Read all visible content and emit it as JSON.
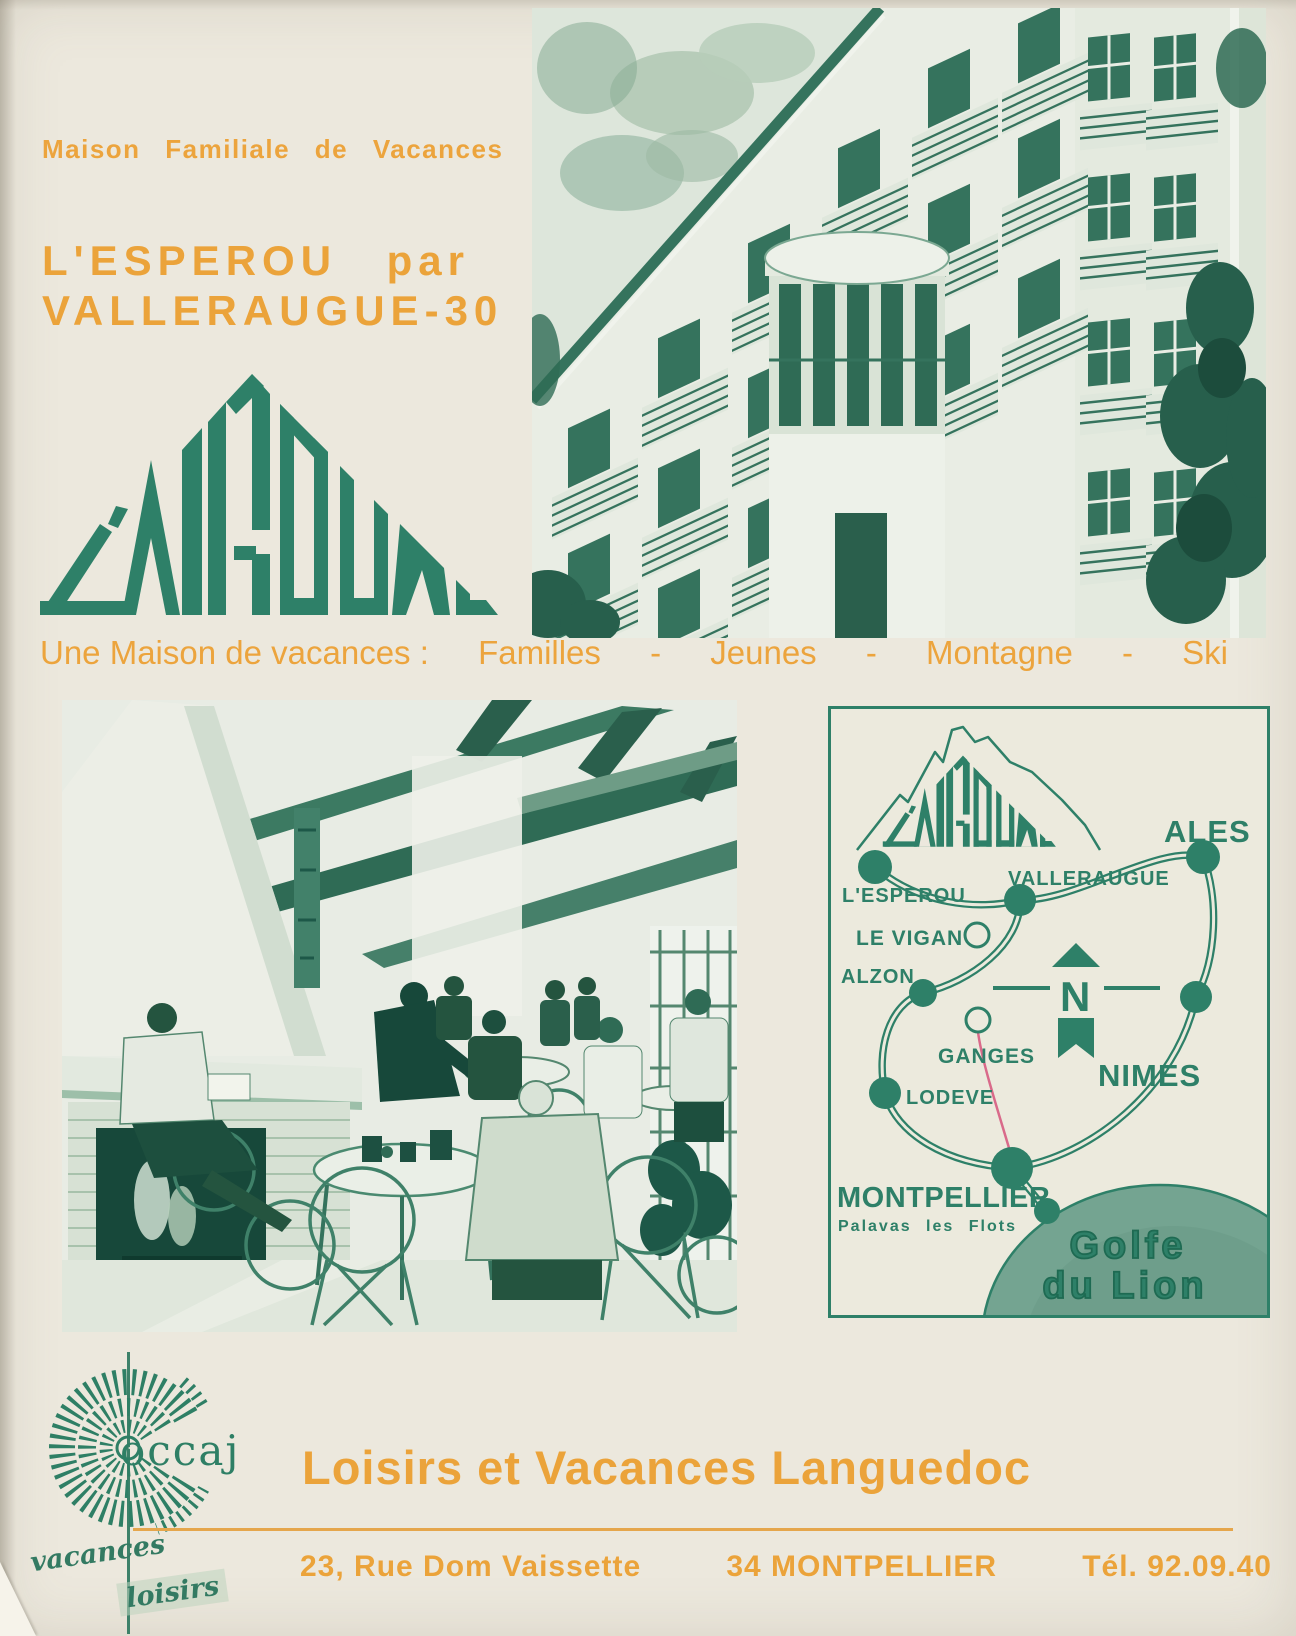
{
  "colors": {
    "green": "#2e8068",
    "orange": "#eca43d",
    "cream": "#ece8dd",
    "map_red": "#d96a8a"
  },
  "header": {
    "eyebrow": "Maison Familiale de Vacances",
    "title1_left": "L'ESPEROU",
    "title1_right": "par",
    "title2_left": "VALLERAUGUE",
    "title2_mid": "-",
    "title2_right": "30",
    "logo_text": "L'AIGOUAL"
  },
  "tagline": {
    "lead": "Une Maison de vacances :",
    "item1": "Familles",
    "sep1": "-",
    "item2": "Jeunes",
    "sep2": "-",
    "item3": "Montagne",
    "sep3": "-",
    "item4": "Ski"
  },
  "map": {
    "logo_text": "L'AIGOUAL",
    "esperou": "L'ESPEROU",
    "valleraugue": "VALLERAUGUE",
    "ales": "ALES",
    "levigan": "LE VIGAN",
    "alzon": "ALZON",
    "ganges": "GANGES",
    "nimes": "NIMES",
    "lodeve": "LODEVE",
    "montpellier": "MONTPELLIER",
    "palavas": "Palavas les Flots",
    "compass": "N",
    "sea1": "Golfe",
    "sea2": "du Lion"
  },
  "footer": {
    "brand": "occaj",
    "script1": "vacances",
    "script2": "loisirs",
    "headline": "Loisirs et Vacances Languedoc",
    "address": "23, Rue Dom Vaissette",
    "city": "34 MONTPELLIER",
    "phone": "Tél. 92.09.40"
  }
}
